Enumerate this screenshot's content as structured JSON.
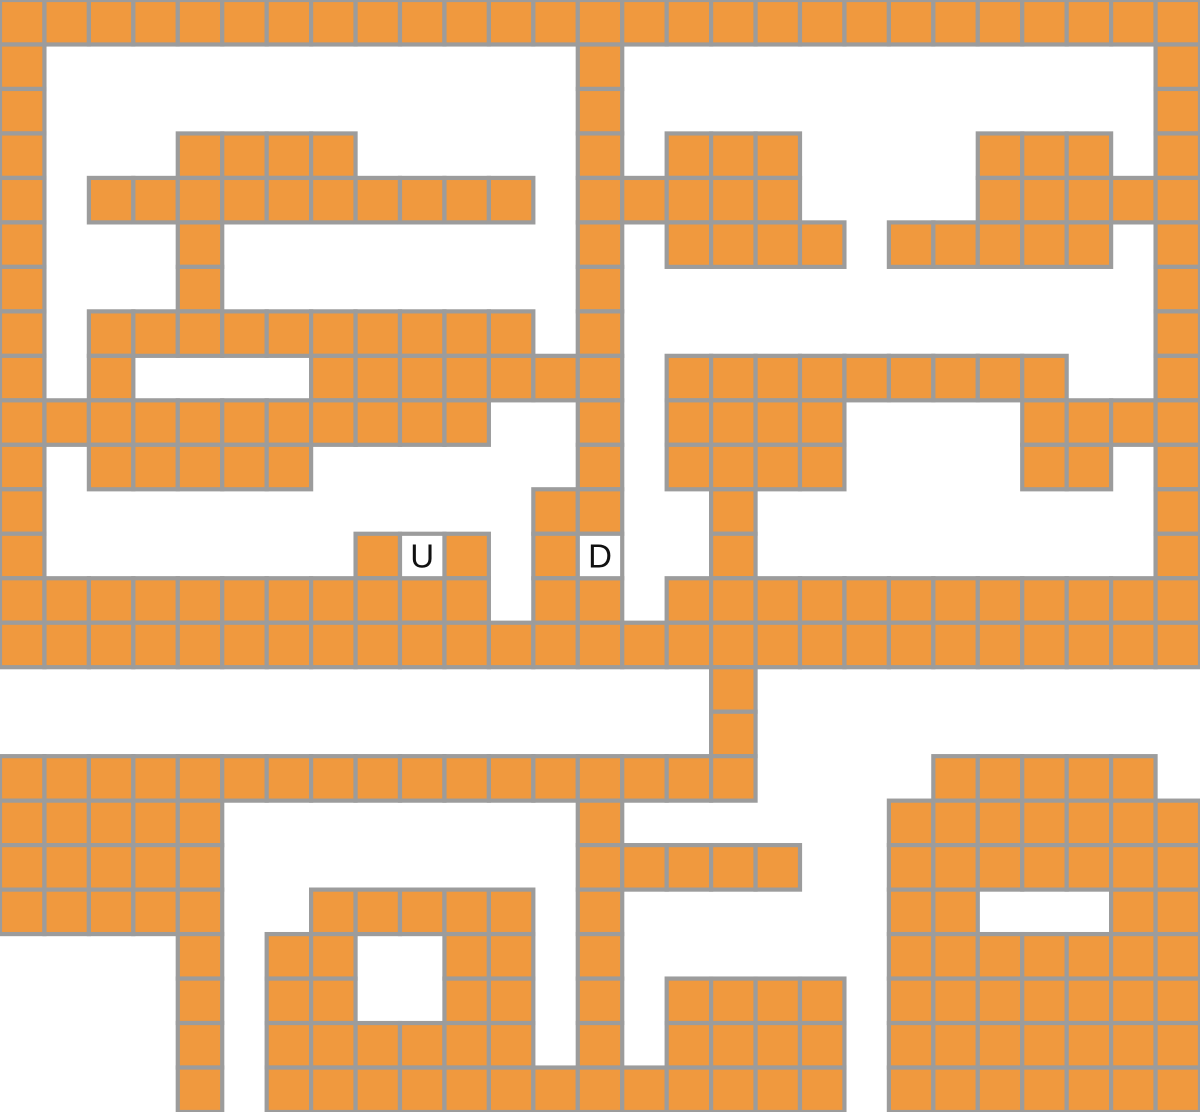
{
  "map": {
    "columns": 27,
    "rows": 25,
    "tile_size_px": 44.44,
    "legend": {
      "wall_tile": "1",
      "empty": "0",
      "stairs_up": "U",
      "stairs_down": "D"
    },
    "markers": [
      {
        "label": "U",
        "name": "stairs-up",
        "row": 12,
        "col": 9
      },
      {
        "label": "D",
        "name": "stairs-down",
        "row": 12,
        "col": 13
      }
    ],
    "tiles": [
      "111111111111111111111111111",
      "100000000000010000000000001",
      "100000000000010000000000001",
      "100011110000010111000011101",
      "101111111111011111000011111",
      "100010000000010111101111101",
      "100010000000010000000000001",
      "101111111111010000000000001",
      "101000011111110111111111001",
      "111111111110010111100001111",
      "101111100000010111100001101",
      "100000000000110010000000001",
      "100000001U101D0010000000001",
      "111111111110110111111111111",
      "111111111111111111111111111",
      "000000000000000010000000000",
      "000000000000000010000000000",
      "111111111111111110000111110",
      "111110000000010000001111111",
      "111110000000011111001111111",
      "111110011111010000001100011",
      "000010110011010000001111111",
      "000010110011010111101111111",
      "000010111111010111101111111",
      "000010111111111111101111111"
    ]
  },
  "colors": {
    "tile_fill": "#F0993E",
    "tile_border": "#9C9C9C",
    "stair_cell_fill": "#FFFFFF",
    "label_text": "#111111",
    "background": "#FFFFFF"
  },
  "label_font_size": 33
}
